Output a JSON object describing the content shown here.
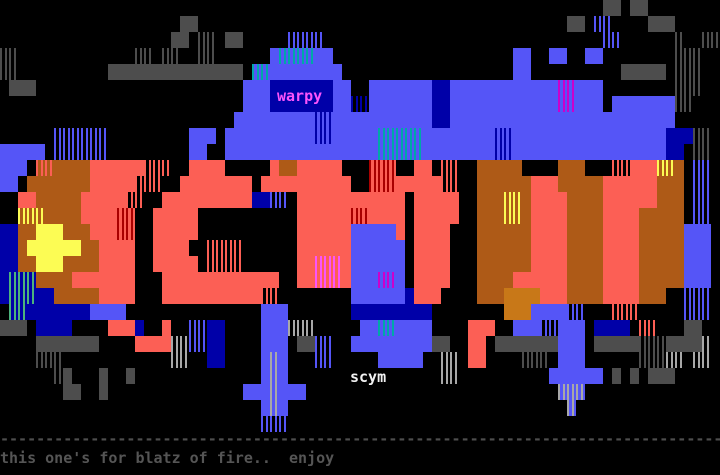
{
  "artwork": {
    "subject": "SCYM graffiti ANSI art",
    "background_color": "#000000"
  },
  "texts": [
    {
      "id": "artist-tag-top",
      "value": "warpy",
      "x": 277,
      "y": 88,
      "color": "#FC54FC"
    },
    {
      "id": "group-tag",
      "value": "scym",
      "x": 350,
      "y": 369,
      "color": "#F2F2F2"
    },
    {
      "id": "divider-dashes",
      "value": "--------------------------------------------------------------------------------",
      "x": 0,
      "y": 431,
      "color": "#4E4E4E"
    },
    {
      "id": "dedication",
      "value": "this one's for blatz of fire..  enjoy",
      "x": 0,
      "y": 450,
      "color": "#555555"
    }
  ],
  "palette": {
    " ": {
      "bg": "#000000"
    },
    "B": {
      "bg": "#5555F7"
    },
    "b": {
      "bg": "#0000A8"
    },
    "R": {
      "bg": "#FC5F55"
    },
    "O": {
      "bg": "#AE5A17"
    },
    "Y": {
      "bg": "#FCFC54"
    },
    "G": {
      "bg": "#4D4D4D"
    },
    "q": {
      "bg": "#C87818"
    },
    "D": {
      "fg": "#5555F7",
      "bg": "#000000"
    },
    "v": {
      "fg": "#0000A8",
      "bg": "#000000"
    },
    "E": {
      "fg": "#0000A8",
      "bg": "#5555F7"
    },
    "T": {
      "fg": "#00A8A8",
      "bg": "#5555F7"
    },
    "m": {
      "fg": "#CC00CC",
      "bg": "#5555F7"
    },
    "L": {
      "fg": "#A8A8A8",
      "bg": "#5555F7"
    },
    "n": {
      "fg": "#4CB37C",
      "bg": "#0000A8"
    },
    "r": {
      "fg": "#A80000",
      "bg": "#FC5F55"
    },
    "p": {
      "fg": "#FC54FC",
      "bg": "#FC5F55"
    },
    "S": {
      "fg": "#FC5F55",
      "bg": "#000000"
    },
    "o": {
      "fg": "#FC5F55",
      "bg": "#AE5A17"
    },
    "y": {
      "fg": "#FCFC54",
      "bg": "#AE5A17"
    },
    "g": {
      "fg": "#4D4D4D",
      "bg": "#000000"
    },
    "l": {
      "fg": "#A8A8A8",
      "bg": "#000000"
    }
  },
  "grid": {
    "cols": 80,
    "cell_w": 9,
    "cell_h": 16,
    "rows": [
      "                                                                   GG GG        ",
      "                    GG                                         GG DD    GGG     ",
      "                   GG gg GG     DDDD                               DD      g  gg ",
      "gg             gg gg  gg      BTTTTBB                    BB  BB  BB        ggg  ",
      "gg          GGGGGGGGGGGGGGG TTBBBBBBBB                   BB          GGGGG ggg  ",
      " GGG                       BBBbbbbbbbBB  BBBBBBBbbBBBBBBBBBBBBmmBBB        ggg  ",
      "                           BBBbbbbbbbBBvvBBBBBBBbbBBBBBBBBBBBBmmBBB BBBBBBBgg   ",
      "                          BBBBBBBBBEEBBBBBBBBBBBbbBBBBBBBBBBBBBBBBBBBBBBBBB     ",
      "      DDDDDD         BBB BBBBBBBBBBEEBBBBBTTTTTBBBBBBBBEEBBBBBBBBBBBBBBBBBbbbgg ",
      "BBBBB DDDDDD         BB  BBBBBBBBBBBBBBBBBTTTTTBBBBBBBBEEBBBBBBBBBBBBBBBBBbb gg ",
      "BBB ooOOOORRRRRRSSS  RRRR     ROORRRRR   rrr  RR SS  OOOOO    OOO   SSRRRyyO DD ",
      "BB OOOOOOORRRRRSSS  RRRRRRRR RRRRRRRRRR  rrrRRRRRSS  OOOOOORRROOOOORRRRRROOO DD ",
      "  RROOOOORRRRRSS  RRRRRRRRRRbbDD RRRRRRRRRRRR RRRRR  OOOyyORRRROOOORRRRRROOO DD ",
      "  yyyOOOORRRRrr  RRRRR           RRRRRRrrRRRR RRRRR  OOOyyORRRROOOORRRROOOOO DD ",
      "bbOOYYYOOORRRrr  RRRRR           RRRRRRBBBBBR RRRR   OOOOOORRRROOOORRRROOOOOBBB ",
      "bbOYYYYYYOORRRR  RRRR  SSSS      RRRRRRBBBBBB RRRR   OOOOOORRRROOOORRRROOOOOBBB ",
      "bbOOYYYOOOORRRR  RRRRR SSSS      RRpppRBBBBBB RRRR   OOOOOORRRROOOORRRROOOOOBBB ",
      "bnnnOOOORRRRRRR   RRRRRRRRRRRRR  RRpppRBBBmmB RRRR   OOOORRRRRROOOORRRROOOOOBBB ",
      "bnnnbbOOOOORRRR   RRRRRRRRRRRSS        BBBBBBbRRR    OOOqqqqRRROOOORRRROOO  DDD ",
      " nnbbbbbbbBBBB               BBB       bbbbbbbbb        qqqBBBBDD   SSS     DDD ",
      "GGG bbbb    RRRb  R  DDbb    BBBlll     BBTTBBBB    RRR  BBBDDBBB bbbb SS   GG  ",
      "    GGGGGGG    RRRRllDDbb    BBB GGDD  BBBBBBBBBGG  RR GGGGGGGBBB GGGGGgggGGGGl ",
      "    ggg            ll  bb    BLB   DD     BBBBB  ll RR    ggg BBB      gggll ll ",
      "      gG   G  G              BLB                 ll          BBBBBB G G GGG     ",
      "       GG  G               BBBLBBB                            LLL               ",
      "                             BLB                               L                ",
      "                             DDD                                                ",
      "                                                                                ",
      "                                                                                ",
      "                                                                                "
    ]
  }
}
